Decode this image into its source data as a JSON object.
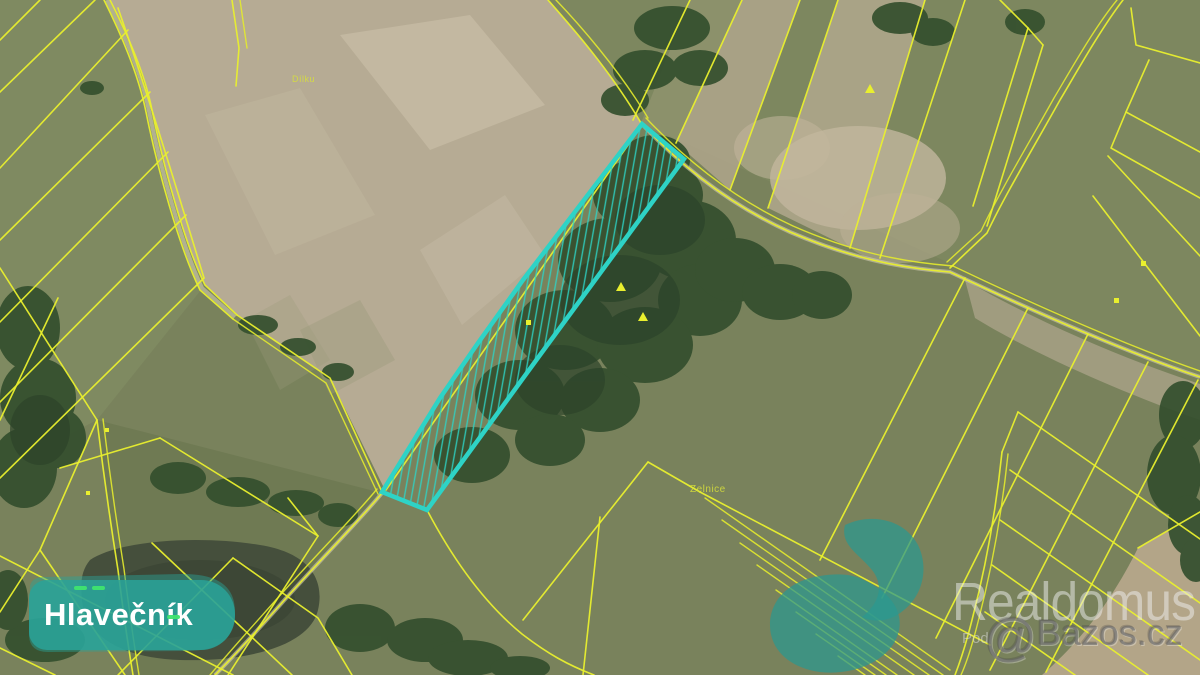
{
  "map": {
    "place_badge": {
      "text": "Hlavečník"
    },
    "field_labels": {
      "dilku": "Dílku",
      "zelnice": "Zelnice"
    }
  },
  "watermarks": {
    "brand": "Realdomus",
    "sub": "Pod",
    "site_at": "@",
    "site_name": "Bazos.cz"
  },
  "highlight_parcel": {
    "points": "642,124 684,159 540,355 427,510 382,492 440,398 478,343 523,280",
    "stroke_color": "#2ed3c6"
  },
  "colors": {
    "cadastral_line": "#e9ef2e",
    "highlight_outline": "#2ed3c6",
    "badge_background": "#2aa399",
    "badge_text": "#ffffff",
    "village_overlay": "#2aa399",
    "bare_field_tan": "#b6ab94",
    "meadow_green": "#79825c",
    "woodland_green": "#344f2e",
    "pond_water": "#454f3c",
    "boundary_dash_green": "#3fe46f",
    "watermark_white": "rgba(240,240,240,0.5)",
    "watermark_gray": "rgba(105,105,105,0.62)"
  }
}
